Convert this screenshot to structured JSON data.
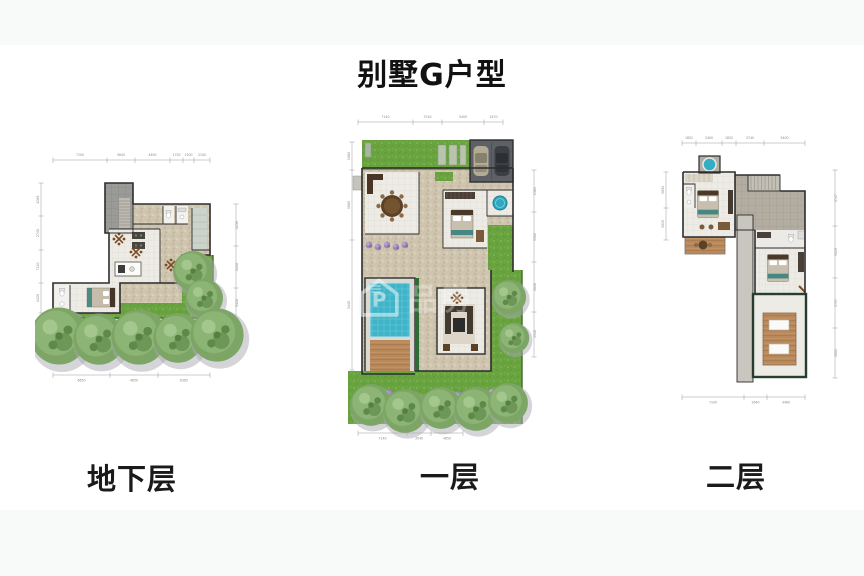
{
  "page": {
    "title": "别墅G户型",
    "background": "#ffffff",
    "band_color": "#f8fafa"
  },
  "watermark": {
    "logo_letter": "P",
    "text": "品房"
  },
  "plans": {
    "basement": {
      "label": "地下层",
      "dims_top": [
        "7100",
        "3640",
        "4630",
        "1750",
        "1500",
        "2100"
      ],
      "dims_bottom": [
        "6650",
        "4650",
        "6365"
      ],
      "dims_left": [
        "4085",
        "2740",
        "7120",
        "4420"
      ],
      "dims_right": [
        "4230",
        "5440",
        "3320"
      ]
    },
    "first": {
      "label": "一层",
      "dims_top": [
        "7140",
        "3740",
        "5400",
        "2470"
      ],
      "dims_bottom": [
        "7140",
        "3540",
        "4650"
      ],
      "dims_left": [
        "1860",
        "5860",
        "3440"
      ],
      "dims_right": [
        "1561",
        "3302",
        "2840",
        "3318"
      ]
    },
    "second": {
      "label": "二层",
      "dims_top": [
        "1852",
        "3400",
        "1832",
        "3740",
        "5400"
      ],
      "dims_bottom": [
        "7100",
        "2640",
        "4460"
      ],
      "dims_left": [
        "3094",
        "3025"
      ],
      "dims_right": [
        "5747",
        "3529",
        "3737",
        "5801"
      ]
    }
  },
  "colors": {
    "grass": "#69a340",
    "pool": "#3fb3c7",
    "wall": "#2d2d2d",
    "stone": "#cfc5af",
    "wood": "#b9895c",
    "garage": "#5d6165",
    "hedge": "#2f6b35"
  }
}
